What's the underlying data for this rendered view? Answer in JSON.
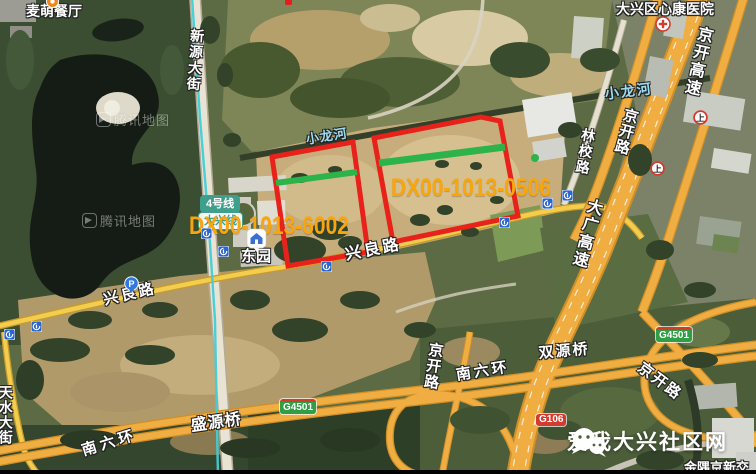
{
  "banner": {
    "text": "爱我大兴社区网",
    "icon": "wechat-icon"
  },
  "map_provider": {
    "watermark_text": "腾讯地图",
    "watermark_positions": [
      {
        "x": 96,
        "y": 110
      },
      {
        "x": 82,
        "y": 211
      }
    ]
  },
  "parcels": [
    {
      "id": "DX00-1013-6002",
      "points": "272,157 353,142 368,252 288,266",
      "green_line": {
        "x1": 276,
        "y1": 183,
        "x2": 357,
        "y2": 172,
        "w": 6
      },
      "label": {
        "x": 189,
        "y": 212
      }
    },
    {
      "id": "DX00-1013-0506",
      "points": "374,138 481,117 500,121 518,216 393,242",
      "green_line": {
        "x1": 379,
        "y1": 163,
        "x2": 505,
        "y2": 147,
        "w": 7
      },
      "label": {
        "x": 391,
        "y": 174
      }
    }
  ],
  "green_dot": {
    "x": 535,
    "y": 158
  },
  "labels": {
    "roads": [
      {
        "text": "新源大街",
        "x": 190,
        "y": 28,
        "mode": "v",
        "rot": 4,
        "size": 14,
        "ls": 2
      },
      {
        "text": "天水大街",
        "x": -2,
        "y": 385,
        "mode": "v",
        "rot": 0,
        "size": 14,
        "ls": 1
      },
      {
        "text": "兴良路",
        "x": 102,
        "y": 293,
        "rot": -13,
        "size": 15,
        "ls": 3
      },
      {
        "text": "兴良路",
        "x": 344,
        "y": 248,
        "rot": -11,
        "size": 16,
        "ls": 3
      },
      {
        "text": "南六环",
        "x": 80,
        "y": 444,
        "rot": -17,
        "size": 15,
        "ls": 4
      },
      {
        "text": "南六环",
        "x": 455,
        "y": 368,
        "rot": -9,
        "size": 15,
        "ls": 3
      },
      {
        "text": "京开高速",
        "x": 696,
        "y": 24,
        "mode": "v",
        "rot": 13,
        "size": 16,
        "ls": 2
      },
      {
        "text": "大广高速",
        "x": 586,
        "y": 196,
        "mode": "v",
        "rot": 15,
        "size": 16,
        "ls": 2
      },
      {
        "text": "京开路",
        "x": 624,
        "y": 106,
        "mode": "v",
        "rot": 15,
        "size": 15,
        "ls": 1
      },
      {
        "text": "京开路",
        "x": 428,
        "y": 341,
        "mode": "v",
        "rot": 8,
        "size": 15,
        "ls": 1
      },
      {
        "text": "京开路",
        "x": 644,
        "y": 360,
        "rot": 37,
        "size": 15,
        "ls": 2
      },
      {
        "text": "林校路",
        "x": 582,
        "y": 127,
        "mode": "v",
        "rot": 10,
        "size": 14,
        "ls": 2
      }
    ],
    "water": [
      {
        "text": "小龙河",
        "x": 604,
        "y": 87,
        "rot": -7,
        "size": 14,
        "ls": 2
      },
      {
        "text": "小龙河",
        "x": 305,
        "y": 133,
        "rot": -9,
        "size": 13,
        "ls": 1
      }
    ],
    "bridges": [
      {
        "text": "双源桥",
        "x": 538,
        "y": 346,
        "rot": -5,
        "size": 15,
        "ls": 2
      },
      {
        "text": "盛源桥",
        "x": 190,
        "y": 419,
        "rot": -8,
        "size": 16,
        "ls": 1
      }
    ],
    "places": [
      {
        "text": "麦萌餐厅",
        "x": 26,
        "y": 4,
        "size": 14
      },
      {
        "text": "大兴区心康医院",
        "x": 616,
        "y": 2,
        "size": 14
      },
      {
        "text": "东园",
        "x": 241,
        "y": 249,
        "size": 15
      },
      {
        "text": "金隅京新交",
        "x": 684,
        "y": 461,
        "size": 13
      }
    ]
  },
  "route_badges": [
    {
      "text": "G4501",
      "x": 280,
      "y": 399,
      "type": "expwy"
    },
    {
      "text": "G4501",
      "x": 656,
      "y": 327,
      "type": "expwy"
    },
    {
      "text": "G106",
      "x": 536,
      "y": 414,
      "type": "nat"
    }
  ],
  "transit": {
    "line_bubbles": [
      {
        "text": "4号线",
        "x": 200,
        "y": 195,
        "style": "solid"
      },
      {
        "text": "大兴线",
        "x": 198,
        "y": 212,
        "style": "outline"
      }
    ],
    "station": {
      "name": "东园",
      "icon_x": 246,
      "icon_y": 228
    },
    "metro_icon_positions": [
      [
        201,
        228
      ],
      [
        218,
        246
      ],
      [
        321,
        261
      ],
      [
        499,
        217
      ],
      [
        542,
        198
      ],
      [
        562,
        190
      ],
      [
        31,
        321
      ],
      [
        4,
        329
      ]
    ]
  },
  "icons": {
    "parking": {
      "glyph": "P",
      "x": 124,
      "y": 276
    },
    "hospital": {
      "x": 655,
      "y": 16
    },
    "restaurant_poi": {
      "x": 46,
      "y": -5
    },
    "ramp_markers": [
      {
        "glyph": "上",
        "x": 693,
        "y": 110
      },
      {
        "glyph": "上",
        "x": 650,
        "y": 161
      }
    ],
    "red_poi_fragment": {
      "x": 285,
      "y": 0
    }
  },
  "colors": {
    "parcel_outline": "#e8221a",
    "parcel_label": "#f7a60f",
    "green_marker": "#2cb34a",
    "metro_line": "#41ced8",
    "metro_line_bubble": "#3f9e8c",
    "highway": "#f0ad42",
    "road_yellow": "#f2cd4e",
    "expressway_badge": "#2f9e44",
    "national_badge": "#d23b2e",
    "metro_icon_blue": "#2a66cc",
    "parking_blue": "#3278e0"
  }
}
